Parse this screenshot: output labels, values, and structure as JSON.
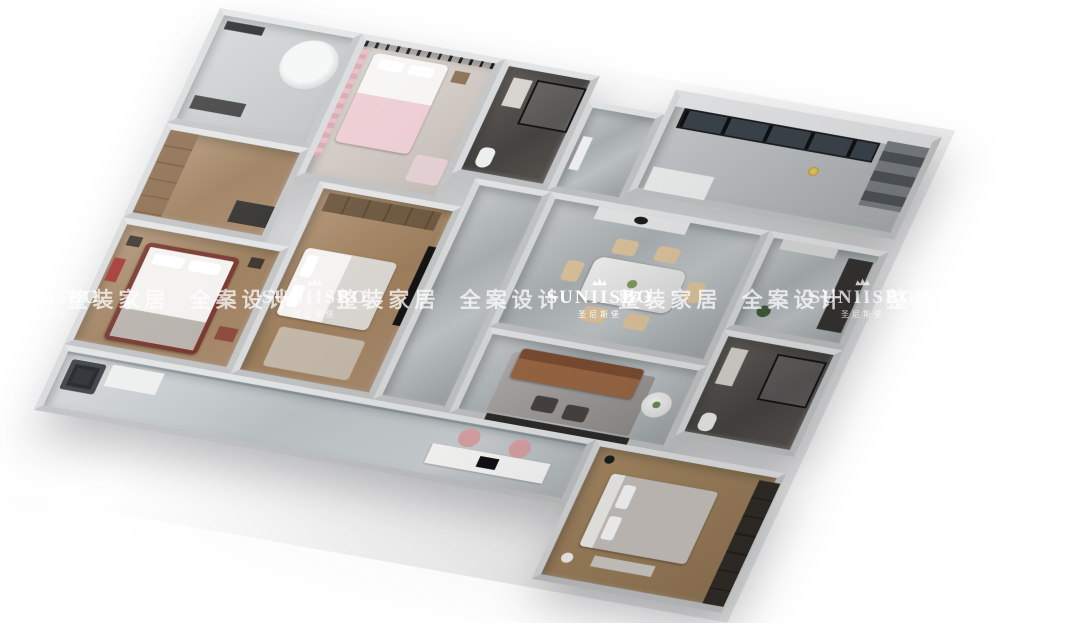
{
  "image": {
    "width": 1080,
    "height": 608,
    "background": "#ffffff",
    "subject": "3d-dollhouse-floorplan-render"
  },
  "watermark": {
    "brand": "SUNIISBO",
    "brand_zh": "圣尼斯堡",
    "tagline": "整装家居 全案设计",
    "color": "#ffffff",
    "crown_icon": "crown-icon",
    "band_y": 299,
    "items": [
      {
        "kind": "logo",
        "x": 47,
        "bright": false
      },
      {
        "kind": "tagline",
        "x": 180,
        "bright": false
      },
      {
        "kind": "logo",
        "x": 315,
        "bright": false
      },
      {
        "kind": "tagline",
        "x": 450,
        "bright": false
      },
      {
        "kind": "logo",
        "x": 600,
        "bright": true
      },
      {
        "kind": "tagline",
        "x": 732,
        "bright": false
      },
      {
        "kind": "logo",
        "x": 863,
        "bright": false
      },
      {
        "kind": "tagline",
        "x": 1000,
        "bright": false
      }
    ]
  },
  "palette": {
    "wall": "#d8dadb",
    "marble_floor": "#b4b8ba",
    "wood_floor": "#a8896c",
    "dark_bath_floor": "#4c4a46",
    "pink_accent": "#e8c4c9",
    "leather_sofa": "#96613f",
    "cream_chair": "#dcc39c",
    "red_bed_frame": "#77362c",
    "gold_wok": "#c9a23f",
    "dark_wardrobe": "#2c2824"
  },
  "scene": {
    "rooms": [
      "bathroom-top",
      "bedroom-pink",
      "bathroom-shower",
      "entry-hall",
      "kitchen",
      "closet-hall",
      "bedroom-red",
      "bedroom-white",
      "corridor",
      "dining-room",
      "foyer",
      "master-bathroom",
      "living-room",
      "master-bedroom",
      "balcony"
    ]
  }
}
